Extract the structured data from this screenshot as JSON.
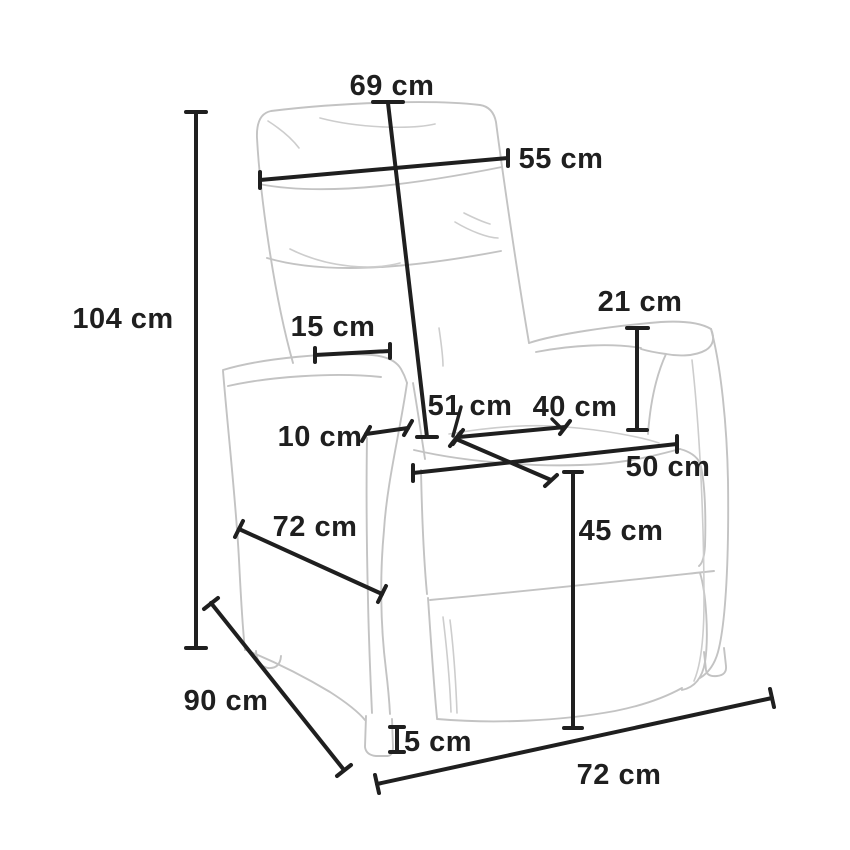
{
  "page": {
    "type": "product-dimension-diagram",
    "subject": "Recliner armchair line drawing with dimension annotations",
    "background_color": "#ffffff",
    "ink_color": "#1f1f1f",
    "outline_color": "#c3c3c3",
    "unit": "cm"
  },
  "diagram": {
    "dimensions": [
      {
        "name": "backrest-height",
        "label": "69 cm",
        "value": 69
      },
      {
        "name": "backrest-width",
        "label": "55 cm",
        "value": 55
      },
      {
        "name": "total-height",
        "label": "104 cm",
        "value": 104
      },
      {
        "name": "backrest-to-armrest",
        "label": "15 cm",
        "value": 15
      },
      {
        "name": "armrest-height",
        "label": "21 cm",
        "value": 21
      },
      {
        "name": "armrest-width",
        "label": "10 cm",
        "value": 10
      },
      {
        "name": "seat-depth",
        "label": "51 cm",
        "value": 51
      },
      {
        "name": "seat-width",
        "label": "40 cm",
        "value": 40
      },
      {
        "name": "seat-front-width",
        "label": "50 cm",
        "value": 50
      },
      {
        "name": "seat-height",
        "label": "45 cm",
        "value": 45
      },
      {
        "name": "side-base-depth",
        "label": "72 cm",
        "value": 72
      },
      {
        "name": "total-depth",
        "label": "90 cm",
        "value": 90
      },
      {
        "name": "foot-height",
        "label": "5 cm",
        "value": 5
      },
      {
        "name": "base-width",
        "label": "72 cm",
        "value": 72
      }
    ]
  }
}
